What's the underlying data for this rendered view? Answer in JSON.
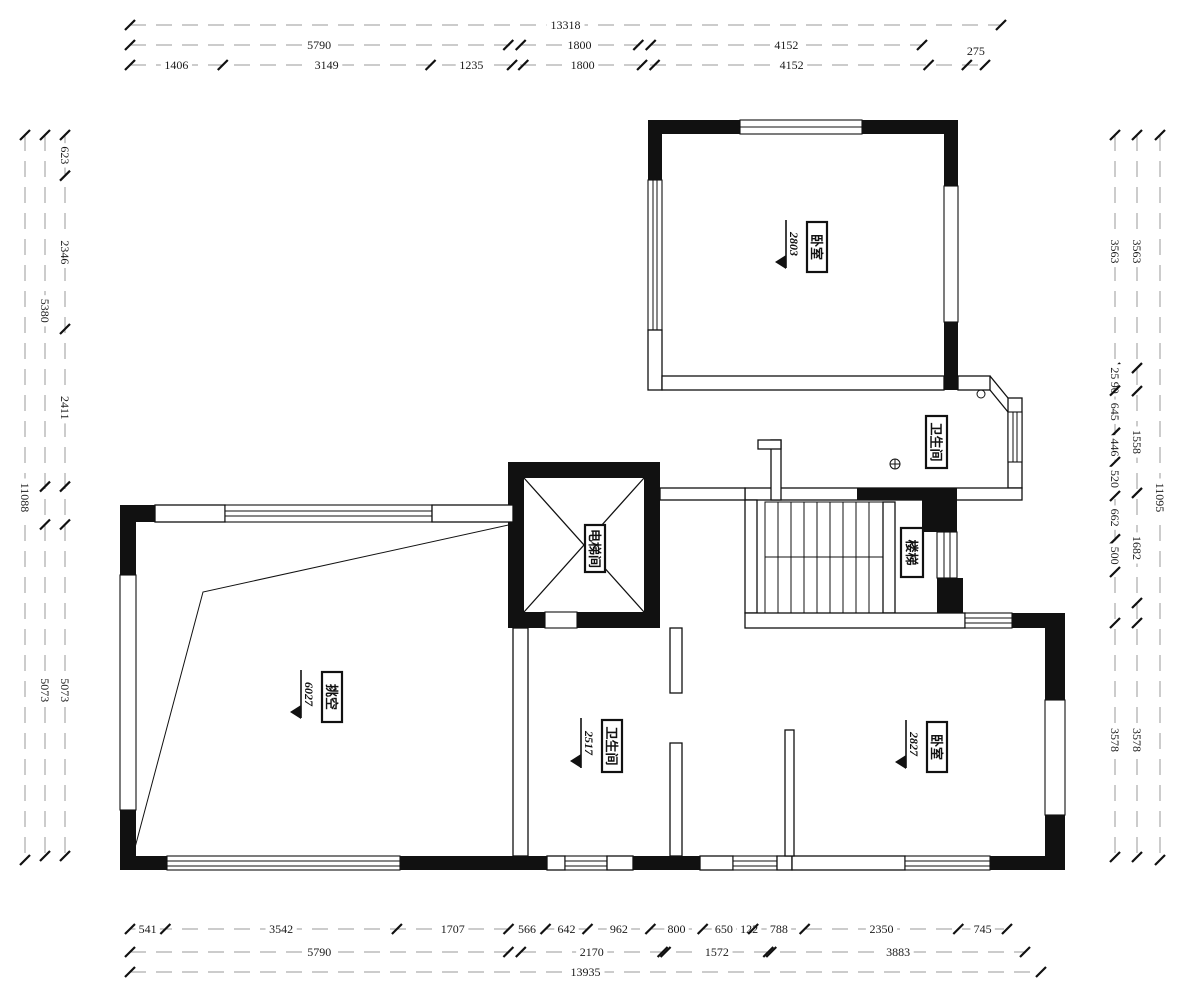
{
  "rooms": [
    {
      "name": "卧室",
      "level": "2803"
    },
    {
      "name": "卫生间",
      "level": ""
    },
    {
      "name": "电梯间",
      "level": ""
    },
    {
      "name": "楼梯",
      "level": ""
    },
    {
      "name": "挑空",
      "level": "6027"
    },
    {
      "name": "卫生间",
      "level": "2517"
    },
    {
      "name": "卧室",
      "level": "2827"
    }
  ],
  "dimensions": {
    "line_color": "#9a9a9a",
    "tick_color": "#111111",
    "chains": [
      {
        "o": "h",
        "pos": 25,
        "start": 130,
        "end": 1001,
        "segs": [
          {
            "v": "13318",
            "u": 13318
          }
        ]
      },
      {
        "o": "h",
        "pos": 45,
        "start": 130,
        "end": 922,
        "segs": [
          {
            "v": "5790",
            "u": 5790
          },
          {
            "v": "",
            "u": 190
          },
          {
            "v": "1800",
            "u": 1800
          },
          {
            "v": "",
            "u": 190
          },
          {
            "v": "4152",
            "u": 4152
          }
        ]
      },
      {
        "o": "h",
        "pos": 65,
        "start": 130,
        "end": 985,
        "segs": [
          {
            "v": "1406",
            "u": 1406
          },
          {
            "v": "3149",
            "u": 3149
          },
          {
            "v": "1235",
            "u": 1235
          },
          {
            "v": "",
            "u": 170
          },
          {
            "v": "1800",
            "u": 1800
          },
          {
            "v": "",
            "u": 190
          },
          {
            "v": "4152",
            "u": 4152
          },
          {
            "v": "",
            "u": 580
          },
          {
            "v": "275",
            "u": 275,
            "dy": -14
          }
        ]
      },
      {
        "o": "h",
        "pos": 929,
        "start": 130,
        "end": 1007,
        "segs": [
          {
            "v": "541",
            "u": 541
          },
          {
            "v": "3542",
            "u": 3542
          },
          {
            "v": "1707",
            "u": 1707
          },
          {
            "v": "566",
            "u": 566
          },
          {
            "v": "642",
            "u": 642
          },
          {
            "v": "962",
            "u": 962
          },
          {
            "v": "800",
            "u": 800
          },
          {
            "v": "650",
            "u": 650
          },
          {
            "v": "122",
            "u": 122
          },
          {
            "v": "788",
            "u": 788
          },
          {
            "v": "2350",
            "u": 2350
          },
          {
            "v": "745",
            "u": 745
          }
        ]
      },
      {
        "o": "h",
        "pos": 952,
        "start": 130,
        "end": 1025,
        "segs": [
          {
            "v": "5790",
            "u": 5790
          },
          {
            "v": "",
            "u": 190
          },
          {
            "v": "2170",
            "u": 2170
          },
          {
            "v": "",
            "u": 45
          },
          {
            "v": "1572",
            "u": 1572
          },
          {
            "v": "",
            "u": 45
          },
          {
            "v": "3883",
            "u": 3883
          }
        ]
      },
      {
        "o": "h",
        "pos": 972,
        "start": 130,
        "end": 1041,
        "segs": [
          {
            "v": "13935",
            "u": 13935
          }
        ]
      },
      {
        "o": "v",
        "pos": 65,
        "start": 135,
        "end": 856,
        "segs": [
          {
            "v": "623",
            "u": 623
          },
          {
            "v": "2346",
            "u": 2346
          },
          {
            "v": "2411",
            "u": 2411
          },
          {
            "v": "",
            "u": 580
          },
          {
            "v": "5073",
            "u": 5073
          }
        ]
      },
      {
        "o": "v",
        "pos": 45,
        "start": 135,
        "end": 856,
        "segs": [
          {
            "v": "5380",
            "u": 5380
          },
          {
            "v": "",
            "u": 580
          },
          {
            "v": "5073",
            "u": 5073
          }
        ]
      },
      {
        "o": "v",
        "pos": 25,
        "start": 135,
        "end": 860,
        "segs": [
          {
            "v": "11088",
            "u": 11088
          }
        ]
      },
      {
        "o": "v",
        "pos": 1115,
        "start": 135,
        "end": 857,
        "segs": [
          {
            "v": "3563",
            "u": 3563
          },
          {
            "v": "256",
            "u": 256
          },
          {
            "v": "90",
            "u": 90
          },
          {
            "v": "645",
            "u": 645
          },
          {
            "v": "446",
            "u": 446
          },
          {
            "v": "520",
            "u": 520
          },
          {
            "v": "662",
            "u": 662
          },
          {
            "v": "500",
            "u": 500
          },
          {
            "v": "",
            "u": 780
          },
          {
            "v": "3578",
            "u": 3578
          }
        ]
      },
      {
        "o": "v",
        "pos": 1137,
        "start": 135,
        "end": 857,
        "segs": [
          {
            "v": "3563",
            "u": 3563
          },
          {
            "v": "",
            "u": 352
          },
          {
            "v": "1558",
            "u": 1558
          },
          {
            "v": "1682",
            "u": 1682
          },
          {
            "v": "",
            "u": 306
          },
          {
            "v": "3578",
            "u": 3578
          }
        ]
      },
      {
        "o": "v",
        "pos": 1160,
        "start": 135,
        "end": 860,
        "segs": [
          {
            "v": "11095",
            "u": 11095
          }
        ]
      }
    ]
  }
}
